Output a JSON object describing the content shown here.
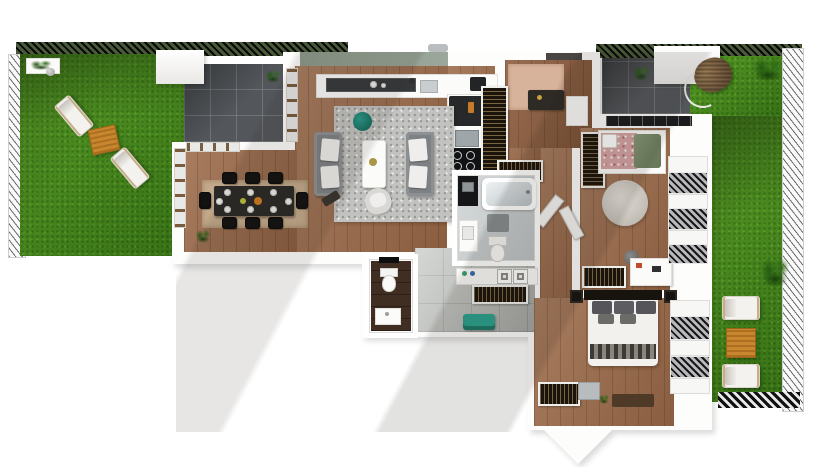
{
  "scene": {
    "kind": "3D top-down apartment floor plan render",
    "outdoor": {
      "left_garden": {
        "items": [
          "lawn",
          "sun lounger",
          "sun lounger",
          "wooden side table",
          "white planter with shrubs",
          "stone sphere"
        ],
        "lounger_count": 2
      },
      "left_patio": {
        "items": [
          "dark paved tile terrace"
        ]
      },
      "top_right_patio": {
        "items": [
          "dark paved tile terrace",
          "potted shrub",
          "hanging wicker chair",
          "white canopy block",
          "palm shrub"
        ]
      },
      "right_garden": {
        "items": [
          "lawn strip",
          "sun lounger",
          "sun lounger",
          "wooden side table",
          "large shrub"
        ],
        "lounger_count": 2
      },
      "fences": [
        "left picket fence",
        "top hedge fence",
        "top-right hedge fence",
        "right picket fence",
        "bottom-right checker fence"
      ]
    },
    "indoor": {
      "living_room": {
        "items": [
          "gray sofa",
          "gray sofa",
          "white coffee table",
          "potted sprig",
          "teal round pouf",
          "speckled gray rug",
          "light armchair",
          "dark side table"
        ]
      },
      "dining_area": {
        "items": [
          "dark dining table set with plates",
          "black chairs x8",
          "beige floor mat",
          "potted plant",
          "glazed doors to garden",
          "window to patio"
        ]
      },
      "kitchen": {
        "items": [
          "white counter",
          "dark hob tray",
          "sink with faucet",
          "tall dark fridge",
          "cooktop with 4 burners",
          "sage feature wall",
          "vent"
        ]
      },
      "entry_hall": {
        "items": [
          "blush runner rug",
          "dark console with brass object",
          "white cabinet",
          "front door"
        ]
      },
      "hallway": {
        "items": [
          "gray tile floor",
          "built-in wardrobe tall",
          "built-in wardrobe short",
          "laundry counter",
          "washer",
          "dryer",
          "wardrobe rail row",
          "teal storage bench",
          "door leaf",
          "door leaf"
        ]
      },
      "bathroom": {
        "items": [
          "bathtub",
          "dark vanity wall",
          "white vanity sink",
          "gray bath mat",
          "toilet"
        ]
      },
      "wc": {
        "items": [
          "dark brown tile floor",
          "toilet",
          "washbasin",
          "black wall shelf"
        ]
      },
      "kids_bedroom": {
        "items": [
          "single bed floral bedding",
          "green blanket",
          "round shaggy rug",
          "tall wardrobe",
          "low wardrobe",
          "white desk",
          "desk chair",
          "clerestory window",
          "side windows with blinds"
        ]
      },
      "master_bedroom": {
        "items": [
          "double bed",
          "dark headboard",
          "gray pillows x5",
          "white duvet",
          "striped throw",
          "nightstand",
          "nightstand",
          "wardrobe dresser",
          "gray cabinet",
          "potted plant",
          "dark door mat",
          "side windows with blinds"
        ]
      }
    }
  },
  "palette": {
    "grass": "#4a8c1e",
    "paved_tile": "#53575b",
    "hall_tile": "#b6b9b5",
    "wood_floor": "#9c6b4a",
    "entry_wood": "#8a5a3c",
    "wall_white": "#fdfdfc",
    "sage_wall": "#93a090",
    "rug_gray": "#c2c2c0",
    "sofa_gray": "#7e8184",
    "accent_teal": "#17796b",
    "bench_teal": "#2aa18e",
    "accent_orange": "#c8872e",
    "wardrobe_dark": "#1b140d",
    "wc_floor": "#402e23",
    "dining_mat": "#c4aa8c",
    "entry_rug": "#d8b39c",
    "doormat_brown": "#4f3a28"
  }
}
